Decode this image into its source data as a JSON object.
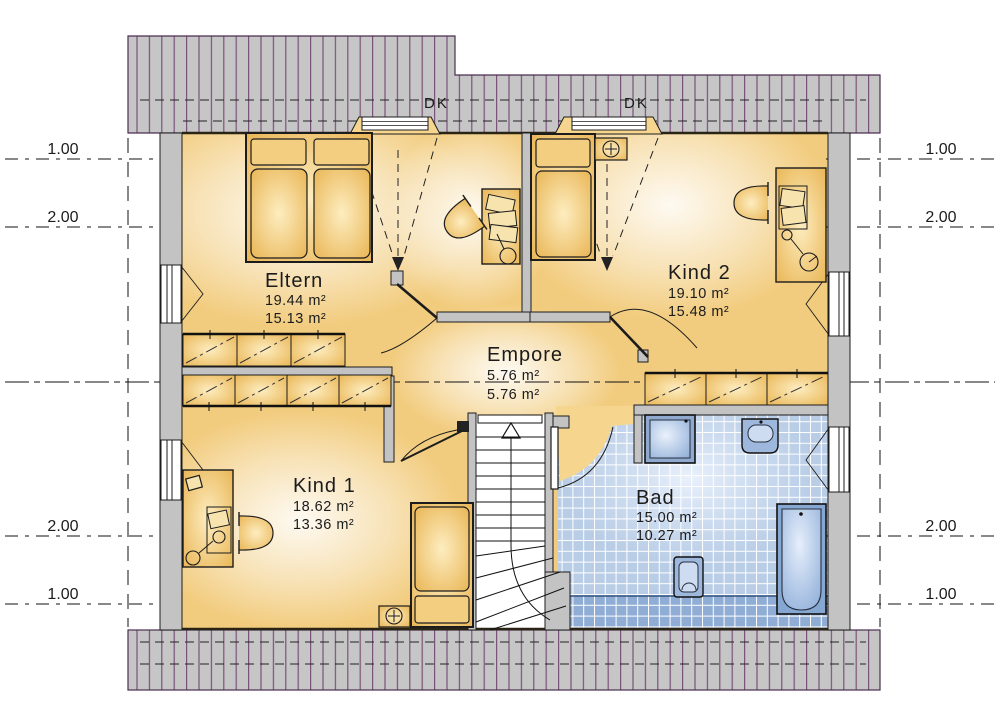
{
  "rooms": {
    "eltern": {
      "name": "Eltern",
      "area1": "19.44 m²",
      "area2": "15.13 m²"
    },
    "kind2": {
      "name": "Kind 2",
      "area1": "19.10 m²",
      "area2": "15.48 m²"
    },
    "empore": {
      "name": "Empore",
      "area1": "5.76 m²",
      "area2": "5.76 m²"
    },
    "kind1": {
      "name": "Kind 1",
      "area1": "18.62 m²",
      "area2": "13.36 m²"
    },
    "bad": {
      "name": "Bad",
      "area1": "15.00 m²",
      "area2": "10.27 m²"
    }
  },
  "roof_windows": [
    {
      "label": "DK"
    },
    {
      "label": "DK"
    }
  ],
  "dims": {
    "left": [
      "1.00",
      "2.00",
      "2.00",
      "1.00"
    ],
    "right": [
      "1.00",
      "2.00",
      "2.00",
      "1.00"
    ]
  },
  "colors": {
    "roof_hatch": "#7a517a",
    "roof_fill": "#c6c6c6",
    "floor_yellow": "#f2cc7e",
    "tile_blue": "#b9cde6",
    "fixture_blue": "#93aed6"
  }
}
